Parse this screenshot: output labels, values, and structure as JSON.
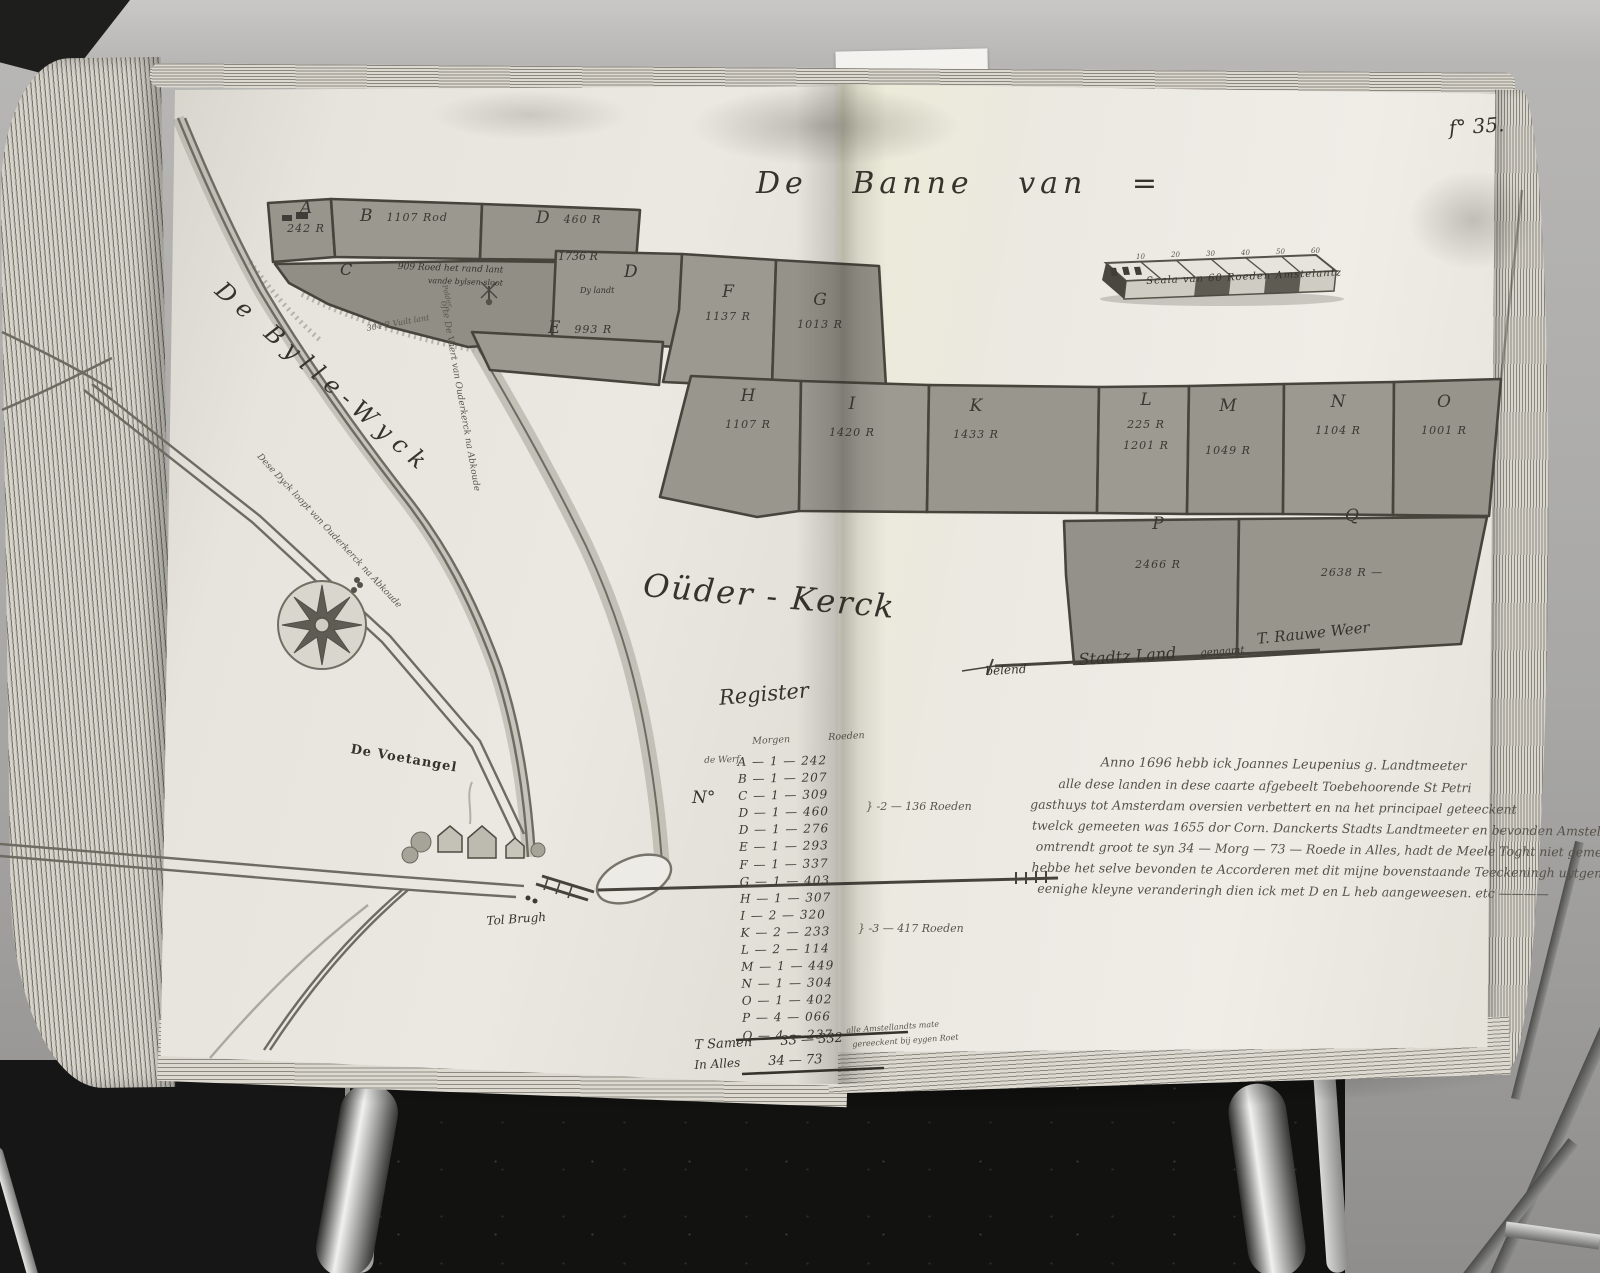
{
  "photo": {
    "folio": "f° 35."
  },
  "map": {
    "title": "De   Banne   van =",
    "place": "Oüder - Kerck",
    "river": "De Bylle-Wyck",
    "scale": {
      "label": "Scala van 60 Roeden Amstelantz",
      "ticks": [
        "10",
        "20",
        "30",
        "40",
        "50",
        "60"
      ]
    },
    "labels": {
      "voetangel": "De Voetangel",
      "brug": "Tol Brugh",
      "polder": "Polder",
      "vuil": "304 R Vuilt lant",
      "vaert": "ofte De Vaert van Ouderkerck na Abkoude",
      "dyck": "Dese Dyck loopt van Ouderkerck na Abkoude",
      "belend": [
        "belend",
        "Stadtz Land",
        "genaamt",
        "T. Rauwe Weer"
      ]
    },
    "parcels": [
      {
        "letter": "A",
        "value": "242 R"
      },
      {
        "letter": "B",
        "value": "1107 Rod"
      },
      {
        "letter": "D",
        "value": "460 R"
      },
      {
        "letter": "C",
        "value": "909 Roed het rand lant",
        "note": "vande bylsen sloot"
      },
      {
        "letter": "D",
        "value": "1736 R",
        "note": "Dy landt"
      },
      {
        "letter": "E",
        "value": "993 R"
      },
      {
        "letter": "F",
        "value": "1137 R"
      },
      {
        "letter": "G",
        "value": "1013 R"
      },
      {
        "letter": "H",
        "value": "1107 R"
      },
      {
        "letter": "I",
        "value": "1420 R"
      },
      {
        "letter": "K",
        "value": "1433 R"
      },
      {
        "letter": "L",
        "value": "225 R",
        "note": "1201 R"
      },
      {
        "letter": "M",
        "value": "1049 R"
      },
      {
        "letter": "N",
        "value": "1104 R"
      },
      {
        "letter": "O",
        "value": "1001 R"
      },
      {
        "letter": "P",
        "value": "2466 R"
      },
      {
        "letter": "Q",
        "value": "2638 R —"
      }
    ]
  },
  "register": {
    "title": "Register",
    "col1": "Morgen",
    "col2": "Roeden",
    "no_label": "N°",
    "pre": "de Werf",
    "rows": [
      "A — 1 — 242",
      "B — 1 — 207",
      "C — 1 — 309",
      "D — 1 — 460",
      "D — 1 — 276",
      "E — 1 — 293",
      "F — 1 — 337",
      "G — 1 — 403",
      "H — 1 — 307",
      "I — 2 — 320",
      "K — 2 — 233",
      "L — 2 — 114",
      "M — 1 — 449",
      "N — 1 — 304",
      "O — 1 — 402",
      "P — 4 — 066",
      "Q — 4 — 237"
    ],
    "brace1": "} -2 — 136 Roeden",
    "brace2": "} -3 — 417 Roeden",
    "sum_label": "T Samen",
    "sum_value": "33 — 332",
    "sum_note1": "alle Amstellandts mate",
    "sum_note2": "gereeckent bij eygen Roet",
    "total_label": "In Alles",
    "total_value": "34 — 73"
  },
  "note": {
    "lines": [
      "Anno 1696 hebb ick Joannes Leupenius g. Landtmeeter",
      "alle dese landen in dese caarte afgebeelt Toebehoorende St Petri",
      "gasthuys tot Amsterdam oversien verbettert en na het principael geteeckent",
      "twelck gemeeten was 1655 dor Corn. Danckerts Stadts Landtmeeter en bevonden Amstel. te",
      "omtrendt groot te syn 34 — Morg — 73 — Roede in Alles, hadt de Meele Toght niet gemeeten",
      "hebbe het selve bevonden te Accorderen met dit mijne bovenstaande Teeckeningh uytgenomen",
      "eenighe kleyne veranderingh dien ick met D en L heb aangeweesen. etc ————"
    ]
  }
}
